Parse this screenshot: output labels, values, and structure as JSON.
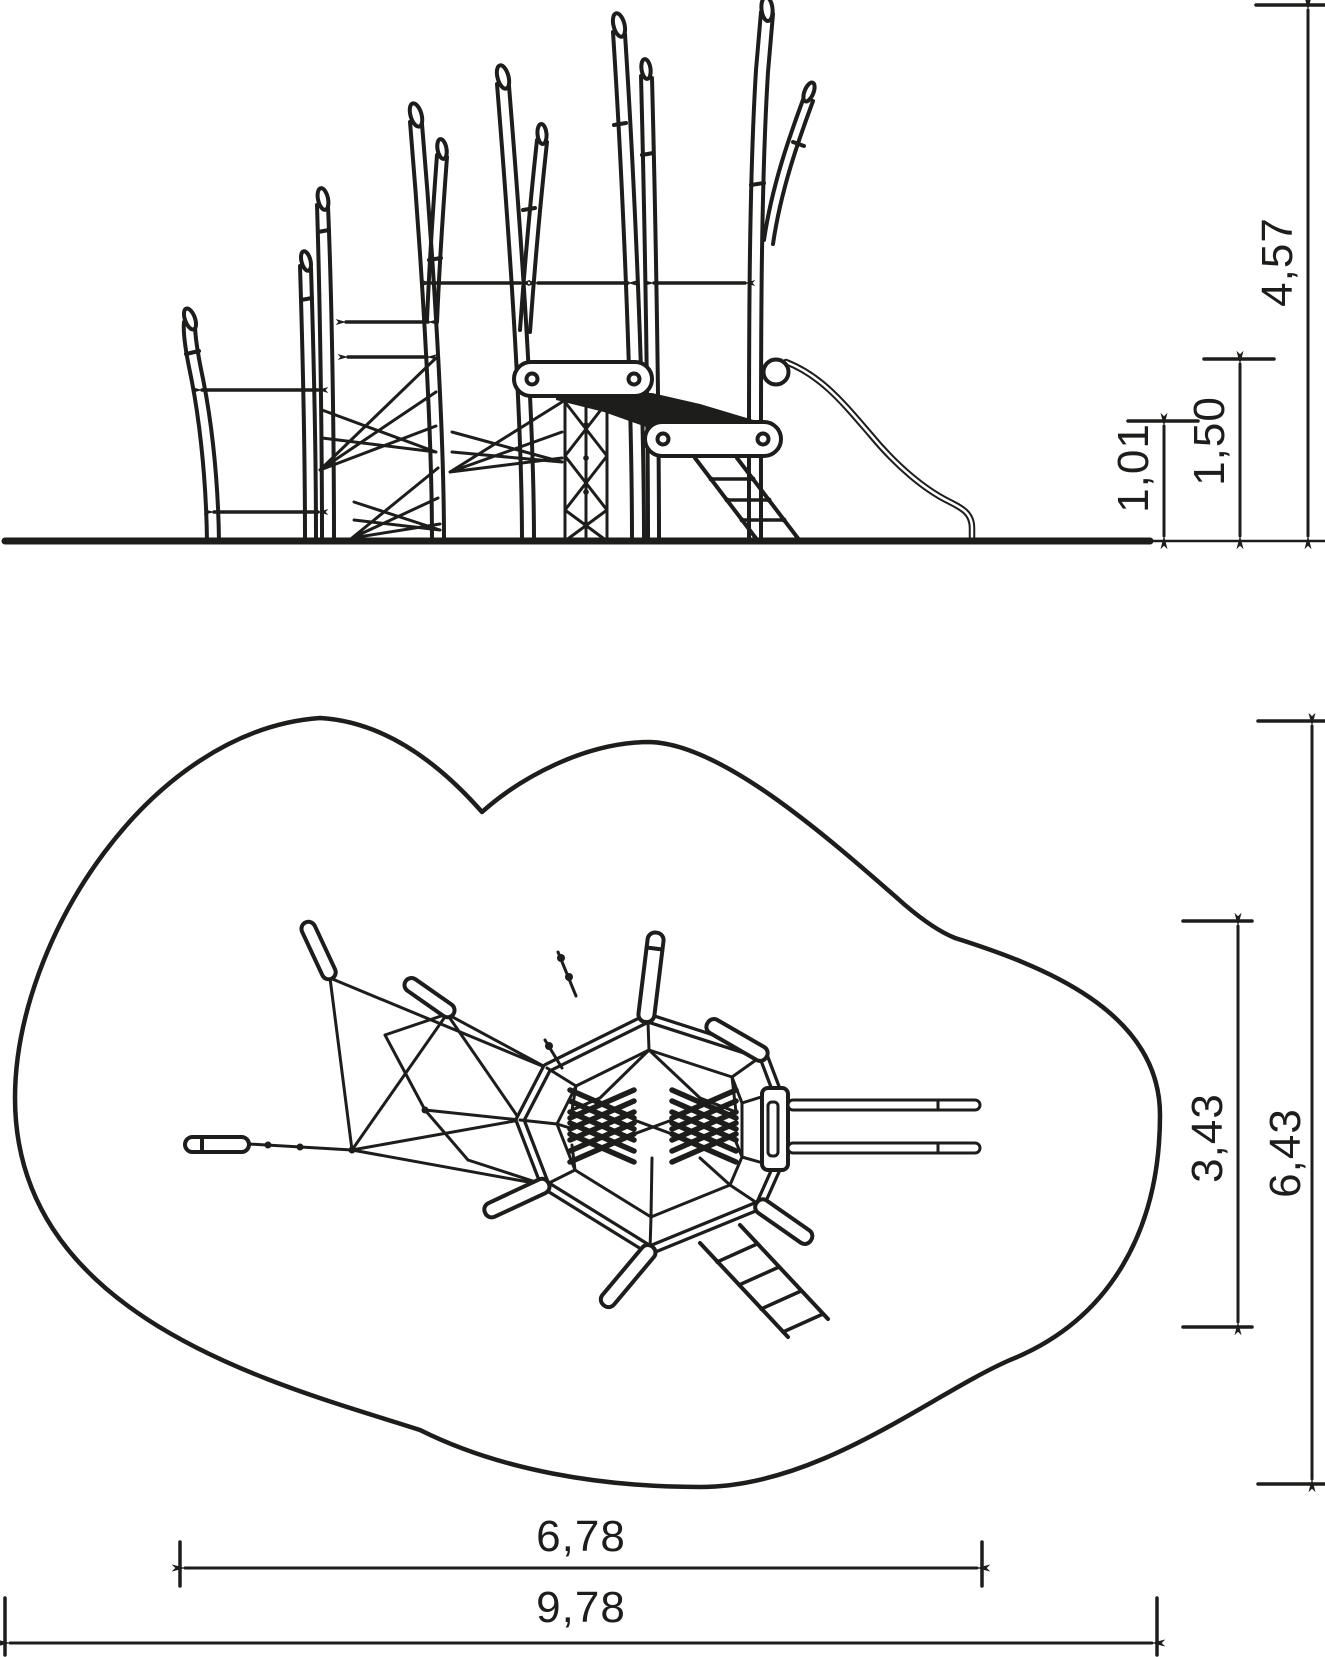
{
  "sheet": {
    "background": "#ffffff",
    "ink": "#1d1d1b",
    "content": "playground climbing structure technical drawing, side elevation and plan view with safety area"
  },
  "elevation_view": {
    "dimensions": {
      "lower_beam_height": {
        "value": "1,01"
      },
      "upper_beam_height": {
        "value": "1,50"
      },
      "total_height": {
        "value": "4,57"
      }
    }
  },
  "plan_view": {
    "dimensions": {
      "structure_depth": {
        "value": "3,43"
      },
      "safety_area_depth": {
        "value": "6,43"
      },
      "structure_width": {
        "value": "6,78"
      },
      "safety_area_width": {
        "value": "9,78"
      }
    }
  }
}
